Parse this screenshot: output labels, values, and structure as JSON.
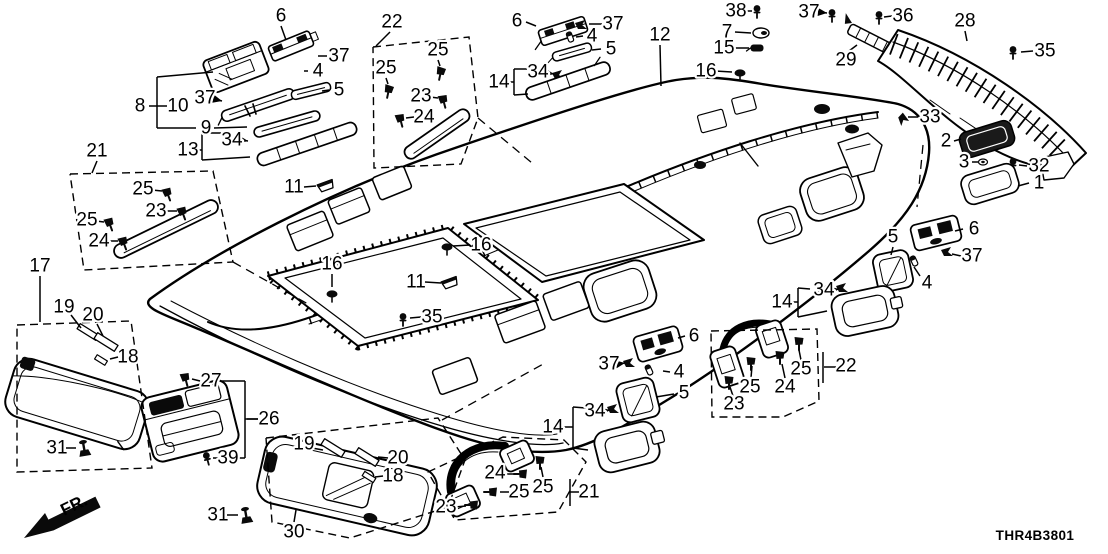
{
  "meta": {
    "diagram_code": "THR4B3801",
    "fr_label": "FR.",
    "line_color": "#000000",
    "background": "#ffffff"
  },
  "callouts": [
    {
      "n": "6",
      "x": 281,
      "y": 16,
      "leader": [
        [
          281,
          26
        ],
        [
          286,
          40
        ]
      ]
    },
    {
      "n": "37",
      "x": 339,
      "y": 56,
      "leader": [
        [
          327,
          56
        ],
        [
          318,
          56
        ]
      ]
    },
    {
      "n": "4",
      "x": 318,
      "y": 71,
      "leader": [
        [
          308,
          71
        ],
        [
          304,
          71
        ]
      ]
    },
    {
      "n": "5",
      "x": 339,
      "y": 90,
      "leader": [
        [
          329,
          90
        ],
        [
          322,
          91
        ]
      ]
    },
    {
      "n": "8",
      "x": 140,
      "y": 106,
      "leader": [
        [
          149,
          106
        ],
        [
          157,
          106
        ]
      ]
    },
    {
      "n": "10",
      "x": 178,
      "y": 106
    },
    {
      "n": "37",
      "x": 205,
      "y": 98,
      "leader": [
        [
          214,
          99
        ],
        [
          222,
          101
        ]
      ],
      "arrow": true
    },
    {
      "n": "9",
      "x": 206,
      "y": 128,
      "leader": [
        [
          214,
          128
        ],
        [
          247,
          127
        ]
      ]
    },
    {
      "n": "34",
      "x": 232,
      "y": 140,
      "leader": [
        [
          241,
          140
        ],
        [
          248,
          141
        ]
      ],
      "arrow": true
    },
    {
      "n": "13",
      "x": 188,
      "y": 150
    },
    {
      "n": "21",
      "x": 97,
      "y": 151,
      "leader": [
        [
          97,
          161
        ],
        [
          92,
          173
        ]
      ]
    },
    {
      "n": "25",
      "x": 143,
      "y": 189,
      "leader": [
        [
          152,
          190
        ],
        [
          162,
          191
        ]
      ]
    },
    {
      "n": "23",
      "x": 156,
      "y": 211,
      "leader": [
        [
          165,
          211
        ],
        [
          177,
          211
        ]
      ]
    },
    {
      "n": "25",
      "x": 87,
      "y": 220,
      "leader": [
        [
          96,
          221
        ],
        [
          104,
          222
        ]
      ]
    },
    {
      "n": "24",
      "x": 99,
      "y": 241,
      "leader": [
        [
          108,
          241
        ],
        [
          118,
          241
        ]
      ]
    },
    {
      "n": "22",
      "x": 392,
      "y": 22,
      "leader": [
        [
          390,
          32
        ],
        [
          376,
          46
        ]
      ]
    },
    {
      "n": "25",
      "x": 438,
      "y": 50,
      "leader": [
        [
          438,
          60
        ],
        [
          440,
          66
        ]
      ]
    },
    {
      "n": "25",
      "x": 386,
      "y": 68,
      "leader": [
        [
          386,
          78
        ],
        [
          388,
          84
        ]
      ]
    },
    {
      "n": "23",
      "x": 421,
      "y": 96,
      "leader": [
        [
          430,
          97
        ],
        [
          438,
          98
        ]
      ]
    },
    {
      "n": "24",
      "x": 424,
      "y": 117,
      "leader": [
        [
          414,
          117
        ],
        [
          406,
          118
        ]
      ]
    },
    {
      "n": "6",
      "x": 517,
      "y": 21,
      "leader": [
        [
          526,
          22
        ],
        [
          536,
          26
        ]
      ]
    },
    {
      "n": "37",
      "x": 613,
      "y": 24,
      "leader": [
        [
          602,
          24
        ],
        [
          589,
          24
        ]
      ]
    },
    {
      "n": "4",
      "x": 592,
      "y": 36,
      "leader": [
        [
          583,
          36
        ],
        [
          576,
          37
        ]
      ]
    },
    {
      "n": "5",
      "x": 611,
      "y": 49,
      "leader": [
        [
          601,
          49
        ],
        [
          592,
          50
        ]
      ]
    },
    {
      "n": "34",
      "x": 538,
      "y": 72,
      "leader": [
        [
          547,
          73
        ],
        [
          554,
          74
        ]
      ],
      "arrow": true
    },
    {
      "n": "14",
      "x": 499,
      "y": 82
    },
    {
      "n": "12",
      "x": 660,
      "y": 35,
      "leader": [
        [
          660,
          45
        ],
        [
          661,
          86
        ]
      ]
    },
    {
      "n": "38",
      "x": 736,
      "y": 11,
      "leader": [
        [
          745,
          11
        ],
        [
          752,
          11
        ]
      ]
    },
    {
      "n": "7",
      "x": 727,
      "y": 32,
      "leader": [
        [
          735,
          32
        ],
        [
          751,
          33
        ]
      ]
    },
    {
      "n": "15",
      "x": 724,
      "y": 48,
      "leader": [
        [
          733,
          48
        ],
        [
          749,
          48
        ]
      ]
    },
    {
      "n": "16",
      "x": 706,
      "y": 71,
      "leader": [
        [
          715,
          71
        ],
        [
          732,
          72
        ]
      ]
    },
    {
      "n": "37",
      "x": 809,
      "y": 12,
      "leader": [
        [
          818,
          12
        ],
        [
          827,
          13
        ]
      ],
      "arrow": true
    },
    {
      "n": "36",
      "x": 903,
      "y": 16,
      "leader": [
        [
          892,
          16
        ],
        [
          884,
          17
        ]
      ]
    },
    {
      "n": "29",
      "x": 846,
      "y": 60,
      "leader": [
        [
          849,
          51
        ],
        [
          857,
          45
        ]
      ]
    },
    {
      "n": "28",
      "x": 965,
      "y": 21,
      "leader": [
        [
          965,
          31
        ],
        [
          967,
          41
        ]
      ]
    },
    {
      "n": "35",
      "x": 1045,
      "y": 51,
      "leader": [
        [
          1033,
          51
        ],
        [
          1021,
          52
        ]
      ]
    },
    {
      "n": "33",
      "x": 930,
      "y": 117,
      "leader": [
        [
          918,
          117
        ],
        [
          908,
          117
        ]
      ]
    },
    {
      "n": "2",
      "x": 946,
      "y": 141,
      "leader": [
        [
          954,
          141
        ],
        [
          961,
          139
        ]
      ]
    },
    {
      "n": "3",
      "x": 964,
      "y": 162,
      "leader": [
        [
          972,
          162
        ],
        [
          978,
          162
        ]
      ]
    },
    {
      "n": "32",
      "x": 1039,
      "y": 166,
      "leader": [
        [
          1027,
          166
        ],
        [
          1019,
          165
        ]
      ]
    },
    {
      "n": "1",
      "x": 1039,
      "y": 183,
      "leader": [
        [
          1029,
          183
        ],
        [
          1018,
          186
        ]
      ]
    },
    {
      "n": "11",
      "x": 294,
      "y": 187,
      "leader": [
        [
          304,
          187
        ],
        [
          316,
          186
        ]
      ]
    },
    {
      "n": "16",
      "x": 332,
      "y": 264,
      "leader": [
        [
          332,
          274
        ],
        [
          332,
          287
        ]
      ]
    },
    {
      "n": "16",
      "x": 481,
      "y": 245,
      "leader": [
        [
          470,
          245
        ],
        [
          453,
          246
        ]
      ]
    },
    {
      "n": "11",
      "x": 416,
      "y": 282,
      "leader": [
        [
          425,
          282
        ],
        [
          441,
          283
        ]
      ]
    },
    {
      "n": "35",
      "x": 432,
      "y": 317,
      "leader": [
        [
          421,
          317
        ],
        [
          410,
          318
        ]
      ]
    },
    {
      "n": "17",
      "x": 40,
      "y": 266,
      "leader": [
        [
          40,
          276
        ],
        [
          40,
          322
        ]
      ]
    },
    {
      "n": "19",
      "x": 64,
      "y": 307,
      "leader": [
        [
          71,
          315
        ],
        [
          81,
          328
        ]
      ]
    },
    {
      "n": "20",
      "x": 93,
      "y": 315,
      "leader": [
        [
          97,
          324
        ],
        [
          103,
          336
        ]
      ]
    },
    {
      "n": "18",
      "x": 128,
      "y": 357,
      "leader": [
        [
          118,
          357
        ],
        [
          110,
          359
        ]
      ]
    },
    {
      "n": "31",
      "x": 57,
      "y": 448,
      "leader": [
        [
          66,
          448
        ],
        [
          76,
          448
        ]
      ]
    },
    {
      "n": "27",
      "x": 211,
      "y": 381,
      "leader": [
        [
          200,
          381
        ],
        [
          192,
          379
        ]
      ]
    },
    {
      "n": "26",
      "x": 269,
      "y": 419,
      "leader": [
        [
          258,
          419
        ],
        [
          247,
          419
        ]
      ]
    },
    {
      "n": "39",
      "x": 228,
      "y": 458,
      "leader": [
        [
          218,
          458
        ],
        [
          213,
          458
        ]
      ]
    },
    {
      "n": "19",
      "x": 304,
      "y": 444,
      "leader": [
        [
          312,
          448
        ],
        [
          323,
          450
        ]
      ]
    },
    {
      "n": "20",
      "x": 398,
      "y": 458,
      "leader": [
        [
          388,
          458
        ],
        [
          378,
          457
        ]
      ]
    },
    {
      "n": "18",
      "x": 393,
      "y": 476,
      "leader": [
        [
          383,
          476
        ],
        [
          375,
          477
        ]
      ]
    },
    {
      "n": "31",
      "x": 218,
      "y": 515,
      "leader": [
        [
          227,
          515
        ],
        [
          238,
          515
        ]
      ]
    },
    {
      "n": "30",
      "x": 294,
      "y": 532,
      "leader": [
        [
          294,
          522
        ],
        [
          296,
          510
        ]
      ]
    },
    {
      "n": "24",
      "x": 495,
      "y": 473,
      "leader": [
        [
          504,
          474
        ],
        [
          514,
          474
        ]
      ]
    },
    {
      "n": "25",
      "x": 543,
      "y": 487,
      "leader": [
        [
          543,
          477
        ],
        [
          541,
          467
        ]
      ]
    },
    {
      "n": "25",
      "x": 519,
      "y": 492,
      "leader": [
        [
          509,
          492
        ],
        [
          500,
          492
        ]
      ]
    },
    {
      "n": "23",
      "x": 446,
      "y": 507,
      "leader": [
        [
          455,
          507
        ],
        [
          466,
          506
        ]
      ]
    },
    {
      "n": "21",
      "x": 589,
      "y": 492,
      "leader": [
        [
          579,
          492
        ],
        [
          570,
          492
        ]
      ]
    },
    {
      "n": "6",
      "x": 694,
      "y": 336,
      "leader": [
        [
          685,
          336
        ],
        [
          678,
          338
        ]
      ]
    },
    {
      "n": "37",
      "x": 609,
      "y": 364,
      "leader": [
        [
          618,
          364
        ],
        [
          625,
          363
        ]
      ],
      "arrow": true
    },
    {
      "n": "4",
      "x": 679,
      "y": 372,
      "leader": [
        [
          670,
          372
        ],
        [
          663,
          371
        ]
      ]
    },
    {
      "n": "5",
      "x": 684,
      "y": 393,
      "leader": [
        [
          674,
          394
        ],
        [
          656,
          397
        ]
      ]
    },
    {
      "n": "34",
      "x": 595,
      "y": 411,
      "leader": [
        [
          604,
          411
        ],
        [
          610,
          410
        ]
      ],
      "arrow": true
    },
    {
      "n": "14",
      "x": 553,
      "y": 427
    },
    {
      "n": "5",
      "x": 893,
      "y": 237,
      "leader": [
        [
          893,
          247
        ],
        [
          891,
          255
        ]
      ]
    },
    {
      "n": "6",
      "x": 974,
      "y": 229,
      "leader": [
        [
          963,
          229
        ],
        [
          955,
          231
        ]
      ]
    },
    {
      "n": "37",
      "x": 972,
      "y": 256,
      "leader": [
        [
          961,
          256
        ],
        [
          952,
          254
        ]
      ]
    },
    {
      "n": "4",
      "x": 927,
      "y": 283,
      "leader": [
        [
          920,
          276
        ],
        [
          914,
          267
        ]
      ]
    },
    {
      "n": "34",
      "x": 824,
      "y": 290,
      "leader": [
        [
          833,
          290
        ],
        [
          839,
          289
        ]
      ],
      "arrow": true
    },
    {
      "n": "14",
      "x": 782,
      "y": 302
    },
    {
      "n": "25",
      "x": 801,
      "y": 369,
      "leader": [
        [
          801,
          360
        ],
        [
          799,
          350
        ]
      ]
    },
    {
      "n": "24",
      "x": 785,
      "y": 387,
      "leader": [
        [
          785,
          378
        ],
        [
          782,
          364
        ]
      ]
    },
    {
      "n": "25",
      "x": 750,
      "y": 387,
      "leader": [
        [
          751,
          378
        ],
        [
          752,
          366
        ]
      ]
    },
    {
      "n": "23",
      "x": 734,
      "y": 404,
      "leader": [
        [
          733,
          396
        ],
        [
          730,
          387
        ]
      ]
    },
    {
      "n": "22",
      "x": 846,
      "y": 366,
      "leader": [
        [
          836,
          367
        ],
        [
          824,
          367
        ]
      ]
    }
  ],
  "brackets": [
    [
      [
        157,
        77
      ],
      [
        157,
        128
      ]
    ],
    [
      [
        157,
        77
      ],
      [
        213,
        72
      ]
    ],
    [
      [
        157,
        128
      ],
      [
        196,
        128
      ]
    ],
    [
      [
        157,
        106
      ],
      [
        167,
        106
      ]
    ],
    [
      [
        197,
        150
      ],
      [
        202,
        150
      ]
    ],
    [
      [
        202,
        133
      ],
      [
        202,
        160
      ]
    ],
    [
      [
        202,
        133
      ],
      [
        221,
        133
      ]
    ],
    [
      [
        202,
        160
      ],
      [
        250,
        157
      ]
    ],
    [
      [
        508,
        82
      ],
      [
        514,
        82
      ]
    ],
    [
      [
        514,
        69
      ],
      [
        514,
        95
      ]
    ],
    [
      [
        514,
        69
      ],
      [
        527,
        69
      ]
    ],
    [
      [
        514,
        95
      ],
      [
        528,
        94
      ]
    ],
    [
      [
        221,
        381
      ],
      [
        245,
        381
      ]
    ],
    [
      [
        245,
        381
      ],
      [
        245,
        458
      ]
    ],
    [
      [
        245,
        458
      ],
      [
        237,
        458
      ]
    ],
    [
      [
        245,
        419
      ],
      [
        258,
        419
      ]
    ],
    [
      [
        562,
        427
      ],
      [
        573,
        427
      ]
    ],
    [
      [
        573,
        407
      ],
      [
        573,
        448
      ]
    ],
    [
      [
        573,
        407
      ],
      [
        586,
        408
      ]
    ],
    [
      [
        573,
        448
      ],
      [
        588,
        450
      ]
    ],
    [
      [
        791,
        302
      ],
      [
        798,
        302
      ]
    ],
    [
      [
        798,
        288
      ],
      [
        798,
        317
      ]
    ],
    [
      [
        798,
        288
      ],
      [
        810,
        289
      ]
    ],
    [
      [
        798,
        317
      ],
      [
        827,
        311
      ]
    ],
    [
      [
        823,
        352
      ],
      [
        823,
        383
      ]
    ],
    [
      [
        570,
        479
      ],
      [
        570,
        506
      ]
    ]
  ],
  "dashed_boxes": [
    [
      [
        70,
        174
      ],
      [
        213,
        171
      ],
      [
        233,
        262
      ],
      [
        84,
        270
      ]
    ],
    [
      [
        373,
        47
      ],
      [
        469,
        37
      ],
      [
        478,
        118
      ],
      [
        461,
        164
      ],
      [
        374,
        168
      ]
    ],
    [
      [
        17,
        325
      ],
      [
        131,
        321
      ],
      [
        152,
        468
      ],
      [
        17,
        472
      ]
    ],
    [
      [
        266,
        438
      ],
      [
        438,
        418
      ],
      [
        465,
        460
      ],
      [
        448,
        507
      ],
      [
        350,
        538
      ],
      [
        272,
        522
      ]
    ],
    [
      [
        428,
        472
      ],
      [
        503,
        437
      ],
      [
        564,
        440
      ],
      [
        586,
        462
      ],
      [
        558,
        512
      ],
      [
        455,
        520
      ]
    ],
    [
      [
        711,
        331
      ],
      [
        817,
        329
      ],
      [
        819,
        401
      ],
      [
        783,
        417
      ],
      [
        712,
        417
      ]
    ]
  ],
  "dashed_lines": [
    [
      [
        233,
        262
      ],
      [
        308,
        304
      ]
    ],
    [
      [
        478,
        118
      ],
      [
        532,
        163
      ]
    ],
    [
      [
        923,
        145
      ],
      [
        917,
        207
      ]
    ],
    [
      [
        442,
        420
      ],
      [
        545,
        363
      ]
    ]
  ]
}
